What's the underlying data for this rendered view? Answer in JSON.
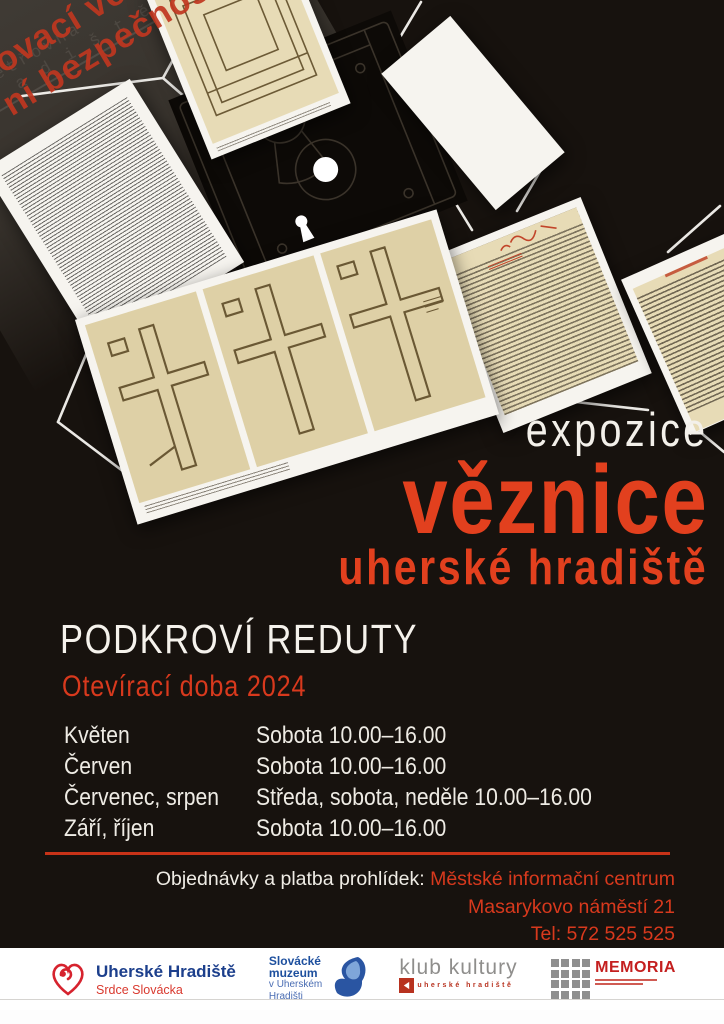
{
  "collage": {
    "faint_line1": "Vyšetřovna",
    "faint_line2": "h r a d i š t ě",
    "stamp_line1": "řovací věznice",
    "stamp_line2": "ní bezpečnosti"
  },
  "title": {
    "kicker": "expozice",
    "main": "věznice",
    "sub": "uherské hradiště"
  },
  "venue": "PODKROVÍ REDUTY",
  "hours_heading": "Otevírací doba 2024",
  "schedule": [
    {
      "months": "Květen",
      "times": "Sobota 10.00–16.00"
    },
    {
      "months": "Červen",
      "times": "Sobota 10.00–16.00"
    },
    {
      "months": "Červenec, srpen",
      "times": "Středa, sobota, neděle 10.00–16.00"
    },
    {
      "months": "Září, říjen",
      "times": "Sobota 10.00–16.00"
    }
  ],
  "contact": {
    "label": "Objednávky a platba prohlídek: ",
    "highlight": "Městské informační centrum",
    "address": "Masarykovo náměstí 21",
    "phone": "Tel: 572 525 525"
  },
  "footer": {
    "uh": {
      "name": "Uherské Hradiště",
      "tagline": "Srdce Slovácka"
    },
    "muzeum": {
      "name_line1": "Slovácké",
      "name_line2": "muzeum",
      "sub_line1": "v Uherském",
      "sub_line2": "Hradišti"
    },
    "klub": {
      "name": "klub kultury",
      "tagline": "uherské hradiště"
    },
    "memoria": {
      "name": "MEMORIA"
    }
  },
  "colors": {
    "accent": "#d8391d",
    "background": "#17120e"
  }
}
